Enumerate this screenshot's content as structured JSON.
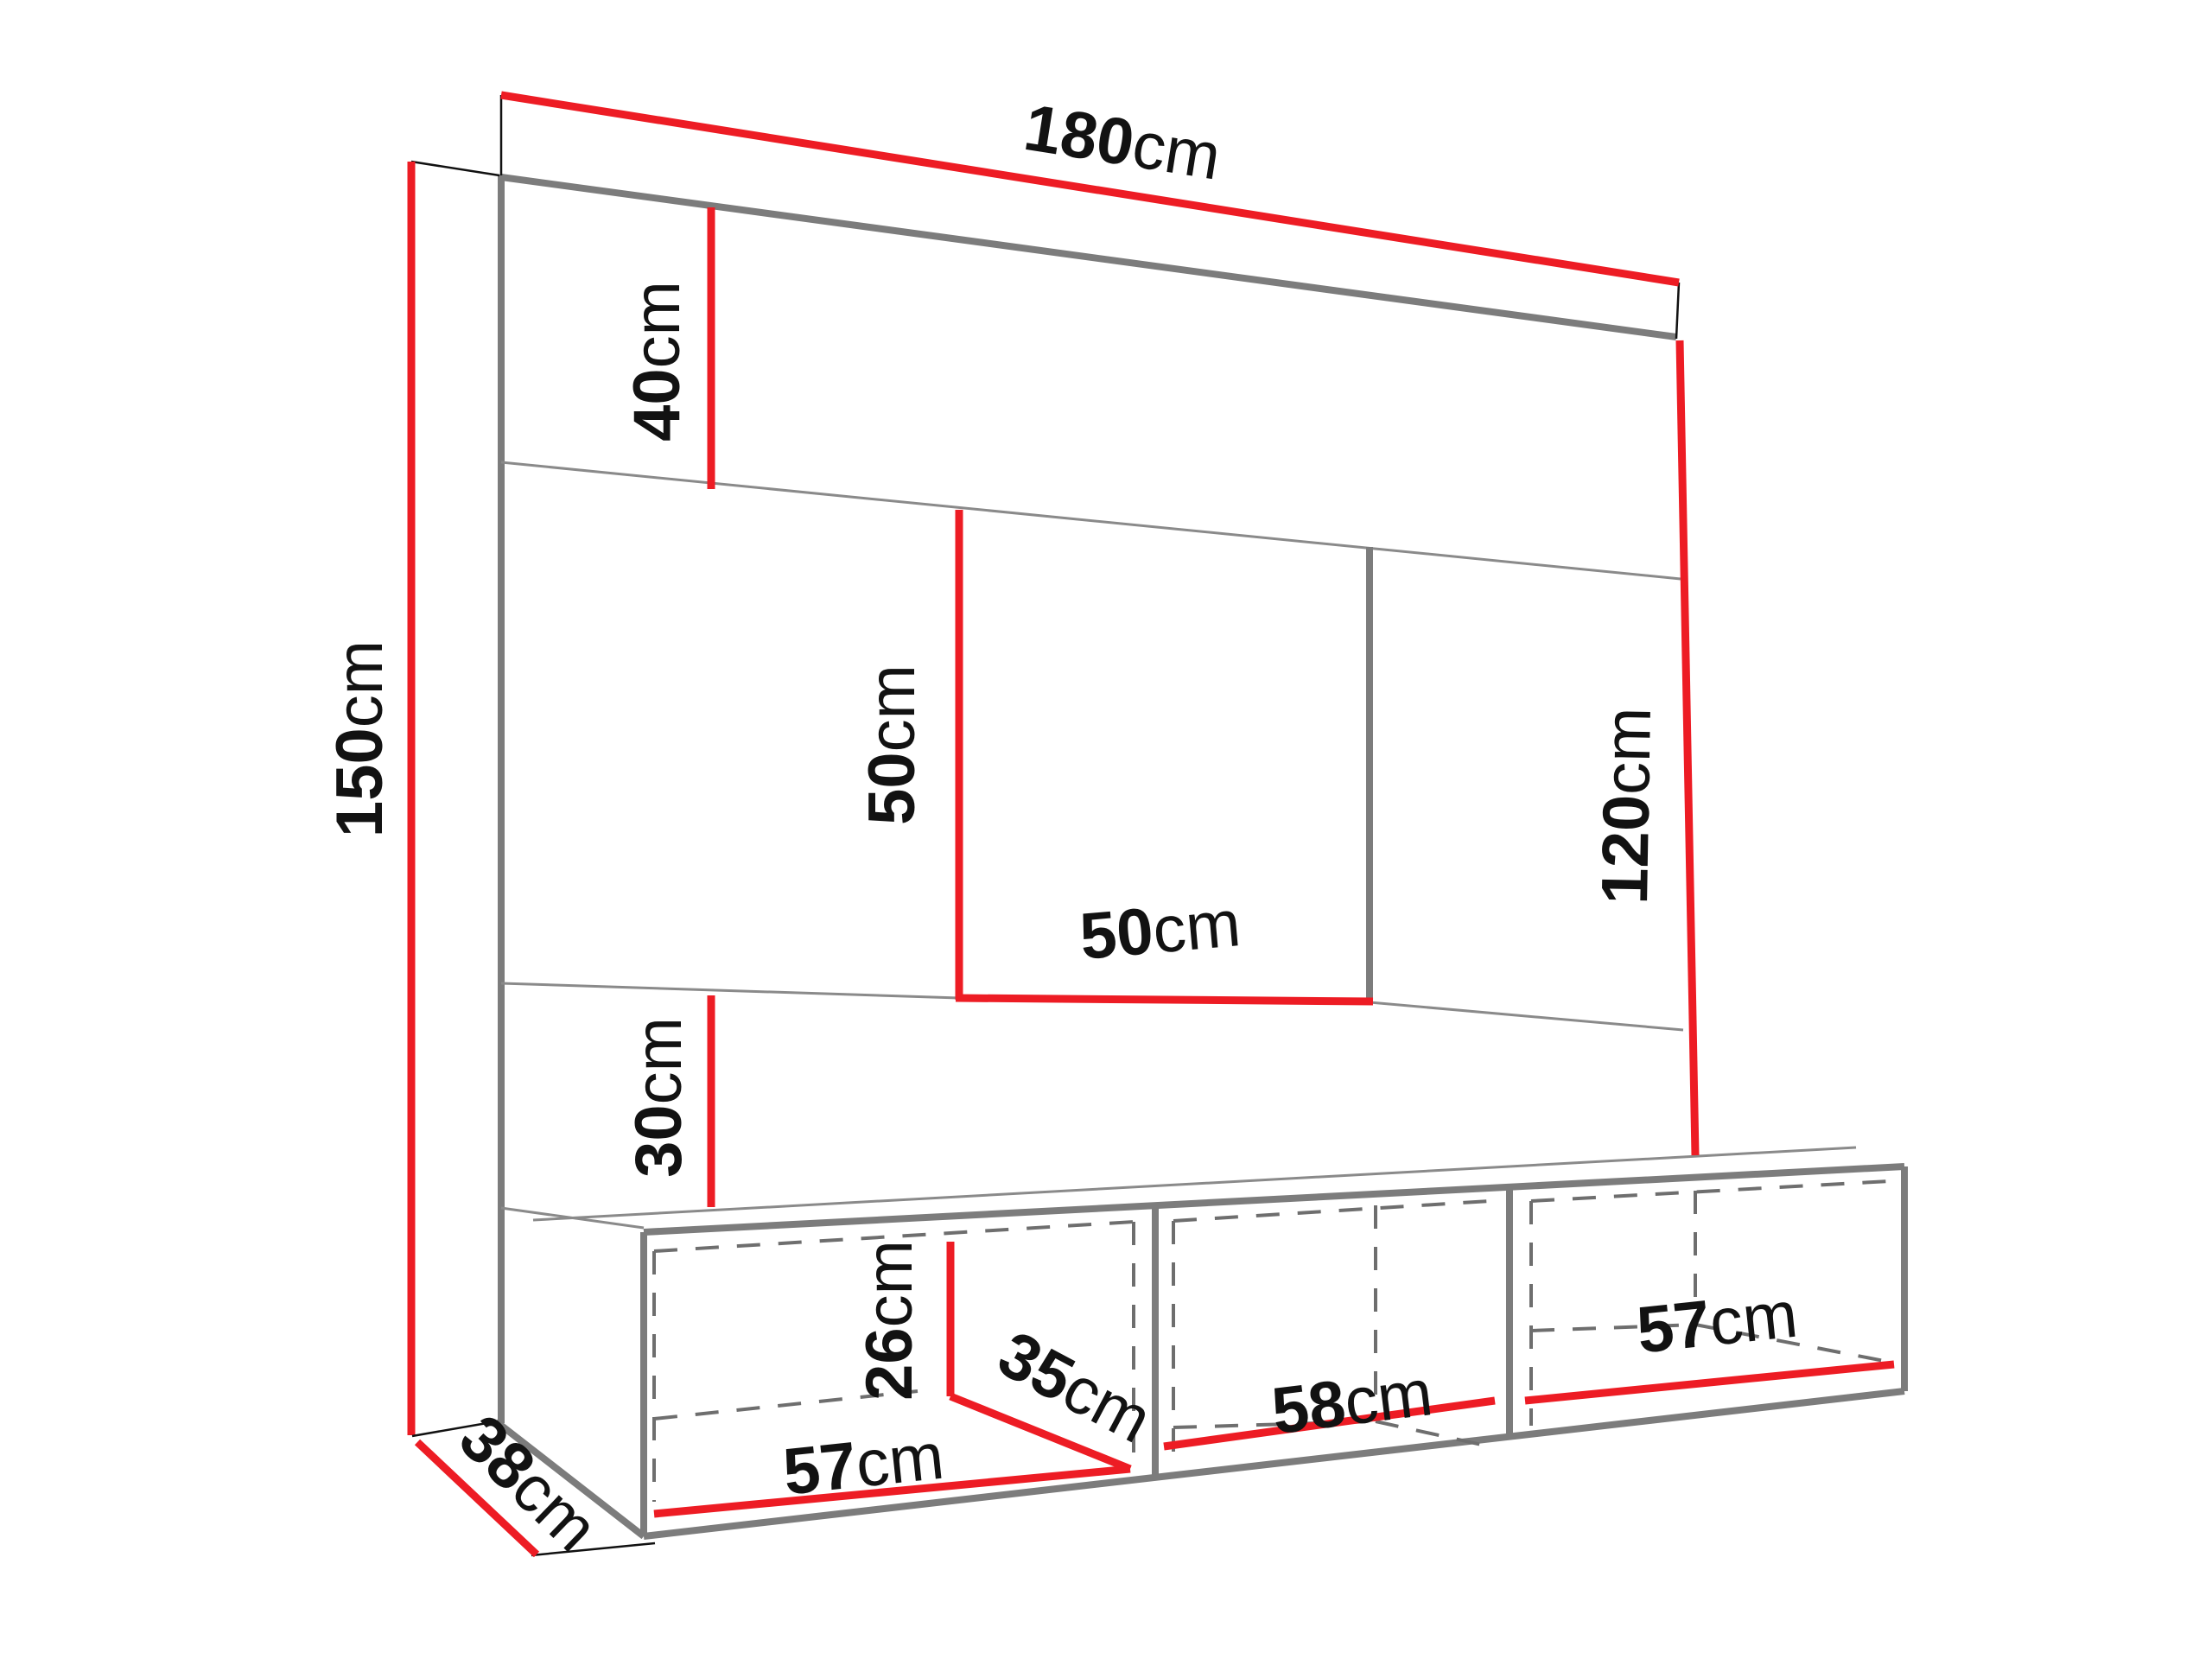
{
  "diagram": {
    "type": "furniture-dimension-diagram",
    "subject": "Wall-mounted TV entertainment unit with top shelf, TV niche and three-compartment base cabinet",
    "unit": "cm",
    "colors": {
      "dimension_line": "#ED1C24",
      "outline": "#7C7C7C",
      "outline_thin": "#8A8A8A",
      "dashed": "#6E6E6E",
      "extension": "#111111",
      "label": "#121212",
      "background": "#FFFFFF"
    },
    "dimensions": {
      "total_width": {
        "value": "180",
        "unit": "cm"
      },
      "top_panel_height": {
        "value": "40",
        "unit": "cm"
      },
      "total_height": {
        "value": "150",
        "unit": "cm"
      },
      "niche_height": {
        "value": "50",
        "unit": "cm"
      },
      "niche_width": {
        "value": "50",
        "unit": "cm"
      },
      "right_height": {
        "value": "120",
        "unit": "cm"
      },
      "bottom_panel_height": {
        "value": "30",
        "unit": "cm"
      },
      "cabinet_height": {
        "value": "26",
        "unit": "cm"
      },
      "cabinet_inner_depth": {
        "value": "35",
        "unit": "cm"
      },
      "compartment_left_width": {
        "value": "57",
        "unit": "cm"
      },
      "compartment_middle_width": {
        "value": "58",
        "unit": "cm"
      },
      "compartment_right_width": {
        "value": "57",
        "unit": "cm"
      },
      "side_depth": {
        "value": "38",
        "unit": "cm"
      }
    }
  }
}
